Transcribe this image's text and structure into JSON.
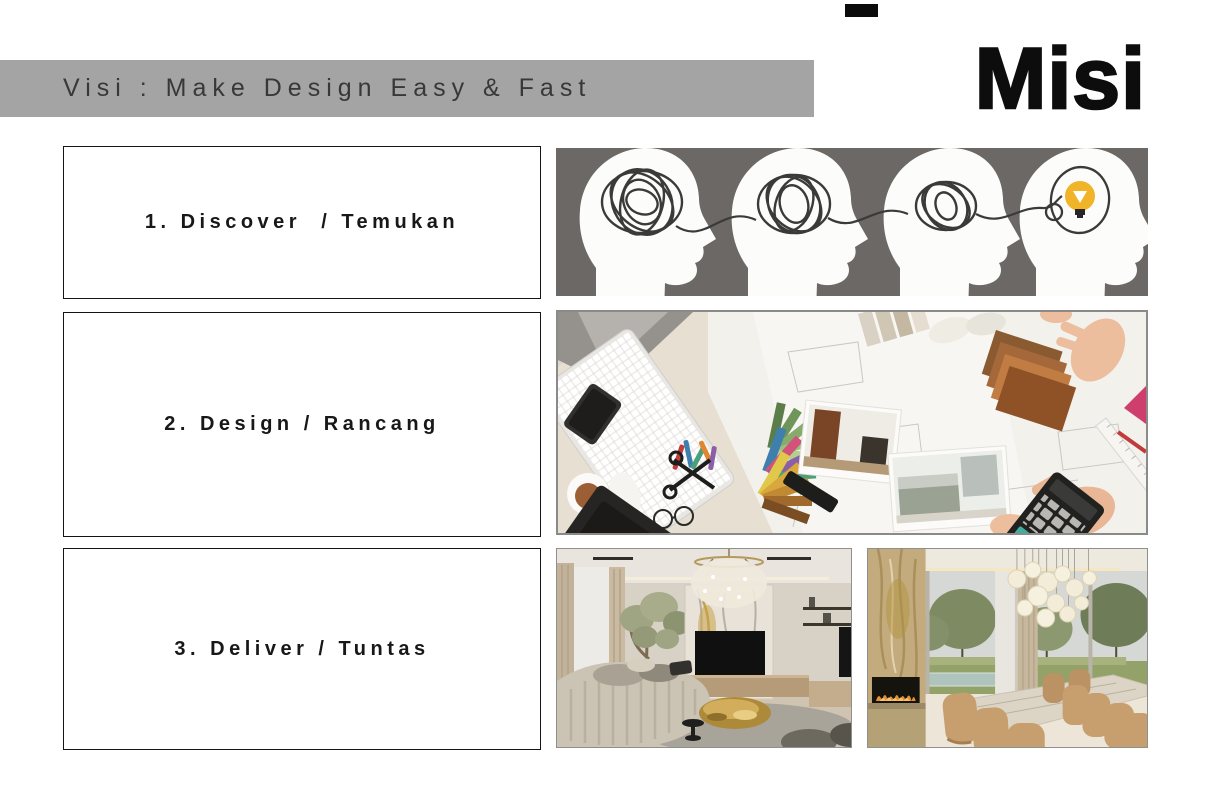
{
  "slide": {
    "vision": {
      "text": "Visi : Make Design Easy & Fast"
    },
    "mission": {
      "text": "Misi"
    },
    "steps": [
      {
        "label": "1. Discover  / Temukan"
      },
      {
        "label": "2. Design / Rancang"
      },
      {
        "label": "3. Deliver / Tuntas"
      }
    ],
    "images": [
      {
        "name": "ideation-illustration",
        "alt": "four head silhouettes with tangled thought lines resolving into a lightbulb idea"
      },
      {
        "name": "workspace-photo",
        "alt": "top view of interior designer desk with keyboard, color swatch fans, floor plans, photos and calculator"
      },
      {
        "name": "living-room-photo",
        "alt": "modern living room with curved beige sofa, marble TV wall, chandelier and gold coffee table"
      },
      {
        "name": "dining-room-photo",
        "alt": "luxury dining room with marble table, tan chairs, bubble chandelier, fireplace and garden view"
      }
    ],
    "colors": {
      "banner_bg": "#a5a4a4",
      "banner_text": "#383838",
      "ideation_bg": "#6b6866",
      "scribble": "#3a3a38",
      "bulb_yellow": "#f0b429"
    }
  }
}
